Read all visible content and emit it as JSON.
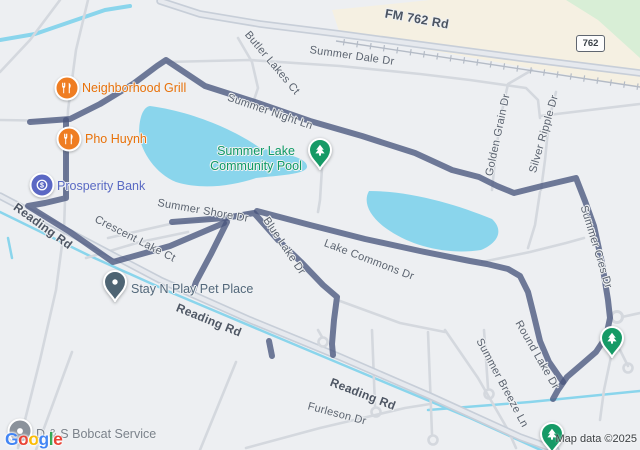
{
  "map": {
    "attribution": "Map data ©2025",
    "shield": {
      "label": "762"
    },
    "logo": {
      "letters": [
        [
          "G",
          "#4285F4"
        ],
        [
          "o",
          "#EA4335"
        ],
        [
          "o",
          "#FBBC05"
        ],
        [
          "g",
          "#4285F4"
        ],
        [
          "l",
          "#34A853"
        ],
        [
          "e",
          "#EA4335"
        ]
      ]
    },
    "colors": {
      "bg": "#edeff2",
      "route": "#49567e",
      "water": "#8ad5ec",
      "road": "#d4d8de",
      "road_casing": "#c7ced8",
      "road_fill": "#e6e9ee",
      "beige": "#f5f0e2",
      "green": "#d8eed6",
      "railroad": "#b4bbc6"
    },
    "road_labels": [
      {
        "id": "fm-762-rd",
        "text": "FM 762 Rd",
        "x": 417,
        "y": 19,
        "rot": 10,
        "cls": "hwy"
      },
      {
        "id": "summer-dale-dr",
        "text": "Summer Dale Dr",
        "x": 352,
        "y": 56,
        "rot": 8,
        "cls": ""
      },
      {
        "id": "butler-lakes-ct",
        "text": "Butler Lakes Ct",
        "x": 272,
        "y": 63,
        "rot": 50,
        "cls": ""
      },
      {
        "id": "summer-night-ln",
        "text": "Summer Night Ln",
        "x": 270,
        "y": 112,
        "rot": 19,
        "cls": ""
      },
      {
        "id": "golden-grain-dr",
        "text": "Golden Grain Dr",
        "x": 498,
        "y": 135,
        "rot": -78,
        "cls": ""
      },
      {
        "id": "silver-ripple-dr",
        "text": "Silver Ripple Dr",
        "x": 544,
        "y": 134,
        "rot": -74,
        "cls": ""
      },
      {
        "id": "summer-cres-dr",
        "text": "Summer Cres Dr",
        "x": 596,
        "y": 247,
        "rot": 73,
        "cls": ""
      },
      {
        "id": "summer-shore-dr",
        "text": "Summer Shore Dr",
        "x": 203,
        "y": 211,
        "rot": 10,
        "cls": ""
      },
      {
        "id": "crescent-lake-ct",
        "text": "Crescent Lake Ct",
        "x": 135,
        "y": 239,
        "rot": 27,
        "cls": ""
      },
      {
        "id": "blue-lake-dr",
        "text": "Blue Lake Dr",
        "x": 284,
        "y": 246,
        "rot": 56,
        "cls": ""
      },
      {
        "id": "lake-commons-dr",
        "text": "Lake Commons Dr",
        "x": 369,
        "y": 260,
        "rot": 21,
        "cls": ""
      },
      {
        "id": "reading-rd-left",
        "text": "Reading Rd",
        "x": 43,
        "y": 226,
        "rot": 36,
        "cls": "rd-bold"
      },
      {
        "id": "reading-rd-mid",
        "text": "Reading Rd",
        "x": 209,
        "y": 320,
        "rot": 22,
        "cls": "rd-bold"
      },
      {
        "id": "reading-rd-bottom",
        "text": "Reading Rd",
        "x": 363,
        "y": 394,
        "rot": 21,
        "cls": "rd-bold"
      },
      {
        "id": "furleson-dr",
        "text": "Furleson Dr",
        "x": 337,
        "y": 414,
        "rot": 15,
        "cls": ""
      },
      {
        "id": "round-lake-dr",
        "text": "Round Lake Dr",
        "x": 537,
        "y": 355,
        "rot": 60,
        "cls": ""
      },
      {
        "id": "summer-breeze-ln",
        "text": "Summer Breeze Ln",
        "x": 502,
        "y": 383,
        "rot": 62,
        "cls": ""
      }
    ],
    "pois": [
      {
        "id": "neighborhood-grill",
        "name": "Neighborhood Grill",
        "icon": "restaurant-icon",
        "marker": "circle",
        "color": "#ef7d22",
        "x": 67,
        "y": 88,
        "label_x": 82,
        "label_y": 88,
        "label_color": "#e8710a"
      },
      {
        "id": "pho-huynh",
        "name": "Pho Huynh",
        "icon": "restaurant-icon",
        "marker": "circle",
        "color": "#ef7d22",
        "x": 69,
        "y": 139,
        "label_x": 85,
        "label_y": 139,
        "label_color": "#e8710a"
      },
      {
        "id": "prosperity-bank",
        "name": "Prosperity Bank",
        "icon": "dollar-icon",
        "marker": "circle",
        "color": "#5b68c4",
        "x": 42,
        "y": 185,
        "label_x": 57,
        "label_y": 186,
        "label_color": "#5a6ac4"
      },
      {
        "id": "summer-lake-community-pool",
        "name": "Summer Lake Community Pool",
        "label_lines": [
          "Summer Lake",
          "Community Pool"
        ],
        "icon": "tree-icon",
        "marker": "pin",
        "color": "#169a66",
        "x": 320,
        "y": 150,
        "label_x": 256,
        "label_y": 159,
        "label_color": "#0f9a66",
        "align": "center"
      },
      {
        "id": "stay-n-play-pet-place",
        "name": "Stay N Play Pet Place",
        "icon": "dot-icon",
        "marker": "pin",
        "color": "#4e6473",
        "x": 115,
        "y": 282,
        "label_x": 131,
        "label_y": 289,
        "label_color": "#53687b"
      },
      {
        "id": "ds-bobcat-service",
        "name": "D & S Bobcat Service",
        "icon": "dot-icon",
        "marker": "circle",
        "color": "#8b929b",
        "x": 20,
        "y": 431,
        "label_x": 36,
        "label_y": 434,
        "label_color": "#7b828b"
      }
    ],
    "park_pins": [
      {
        "x": 612,
        "y": 338
      },
      {
        "x": 552,
        "y": 434
      }
    ]
  },
  "geometry": {
    "beige": "332,10 430,0 640,0 640,88 340,34",
    "green": "566,0 640,0 640,58 598,20",
    "lakes": [
      "M150,106 C195,112 238,132 260,148 C288,154 306,158 307,166 C308,174 282,175 256,178 C232,186 202,190 176,182 C156,174 141,152 139,134 C139,118 143,107 150,106 Z",
      "M369,191 C412,191 458,205 492,219 C503,229 500,242 481,250 C449,255 414,247 390,231 C371,219 362,203 369,191 Z"
    ],
    "canals": [
      {
        "p": "0,212 90,256 170,292 260,330 360,372 470,418 545,452",
        "w": 2.5
      },
      {
        "p": "428,410 530,402 640,391",
        "w": 2.5
      },
      {
        "p": "0,40 35,34 70,22 105,10 130,6",
        "w": 4
      },
      {
        "p": "8,238 12,258",
        "w": 2.5
      }
    ],
    "roads_minor": [
      "88,0 76,50 68,110 66,170 64,230 56,290 40,360 18,448",
      "60,0 30,40 0,72",
      "0,120 66,121",
      "166,62 250,60 340,66 420,74 470,80 526,88 538,100 540,118",
      "238,38 252,62 258,88 252,106",
      "532,70 508,84 500,120 494,170 492,190",
      "556,92 549,120 545,160 541,190",
      "540,116 640,104",
      "108,238 170,224 230,216 256,212",
      "86,258 140,242 188,232",
      "322,168 320,200 318,212",
      "540,192 535,225 528,248",
      "482,262 530,252 566,243 584,238",
      "372,330 375,406",
      "428,332 432,434",
      "484,330 488,388",
      "620,350 628,366",
      "445,330 478,378 508,430 516,448",
      "246,448 320,428 405,408 430,404",
      "36,450 72,352",
      "200,450 236,362",
      "340,301 400,323 445,332",
      "622,317 640,313",
      "612,352 604,390 600,420",
      "318,330 322,337"
    ],
    "culdesacs": [
      [
        376,
        412
      ],
      [
        433,
        440
      ],
      [
        489,
        394
      ],
      [
        628,
        368
      ],
      [
        323,
        342
      ]
    ],
    "roundabout": {
      "x": 617,
      "y": 317,
      "r": 5.5
    },
    "roads_major": [
      "0,196 80,238 160,280 250,320 340,357 430,396 520,437 556,450",
      "160,1 200,14 260,24 340,34 430,46 520,58 600,68 640,73"
    ],
    "railroad": {
      "x1": 336,
      "y1": 41,
      "x2": 640,
      "y2": 87
    },
    "route": [
      "30,122 70,119 100,104 133,84 157,66 166,60 205,86 255,102 310,121 362,136 415,153 452,170 479,177 497,186 514,193 542,186 576,178 585,201 594,226 602,263 608,300 610,318 606,337 596,352 581,365 567,377 558,390 553,399",
      "66,120 66,160 66,198 45,203 28,206 70,232 113,262 170,246 224,223",
      "172,222 225,218 254,213 278,240 301,262 323,285 337,297 334,320 332,344 333,355",
      "227,222 211,254 196,282 193,291",
      "257,211 310,225 365,239 420,251 470,261 487,264 508,269 520,276 528,292 534,316 540,341 549,362 558,375 563,382",
      "269,341 272,356"
    ]
  }
}
